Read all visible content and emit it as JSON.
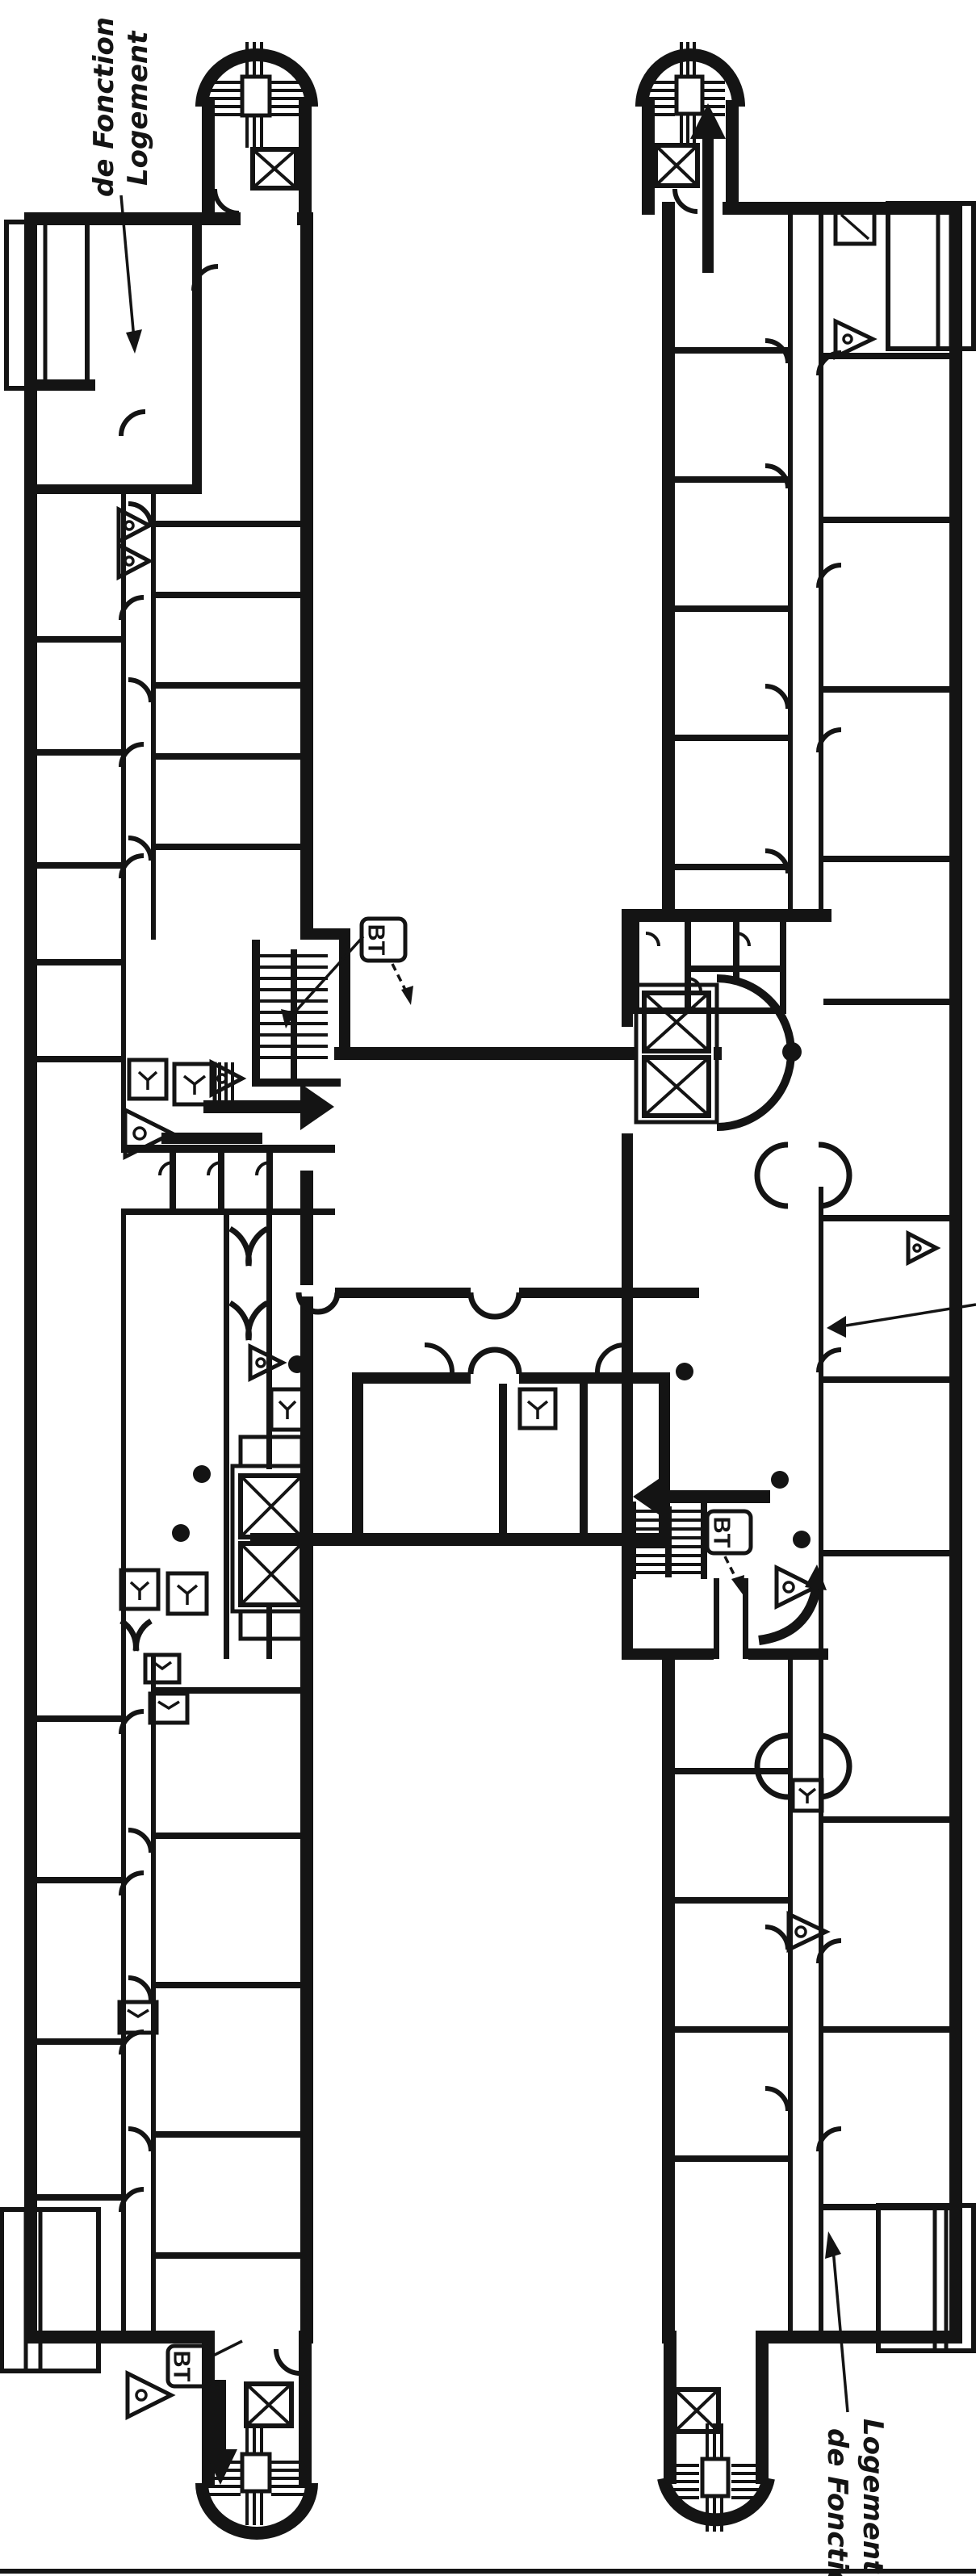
{
  "colors": {
    "ink": "#141414",
    "paper": "#ffffff"
  },
  "labels": {
    "logement_top": {
      "line1": "Logement",
      "line2": "de Fonction"
    },
    "logement_bottom": {
      "line1": "Logement",
      "line2": "de Fonction"
    },
    "bt_mid_left": "BT",
    "bt_mid_right": "BT",
    "bt_bottom_left": "BT"
  }
}
